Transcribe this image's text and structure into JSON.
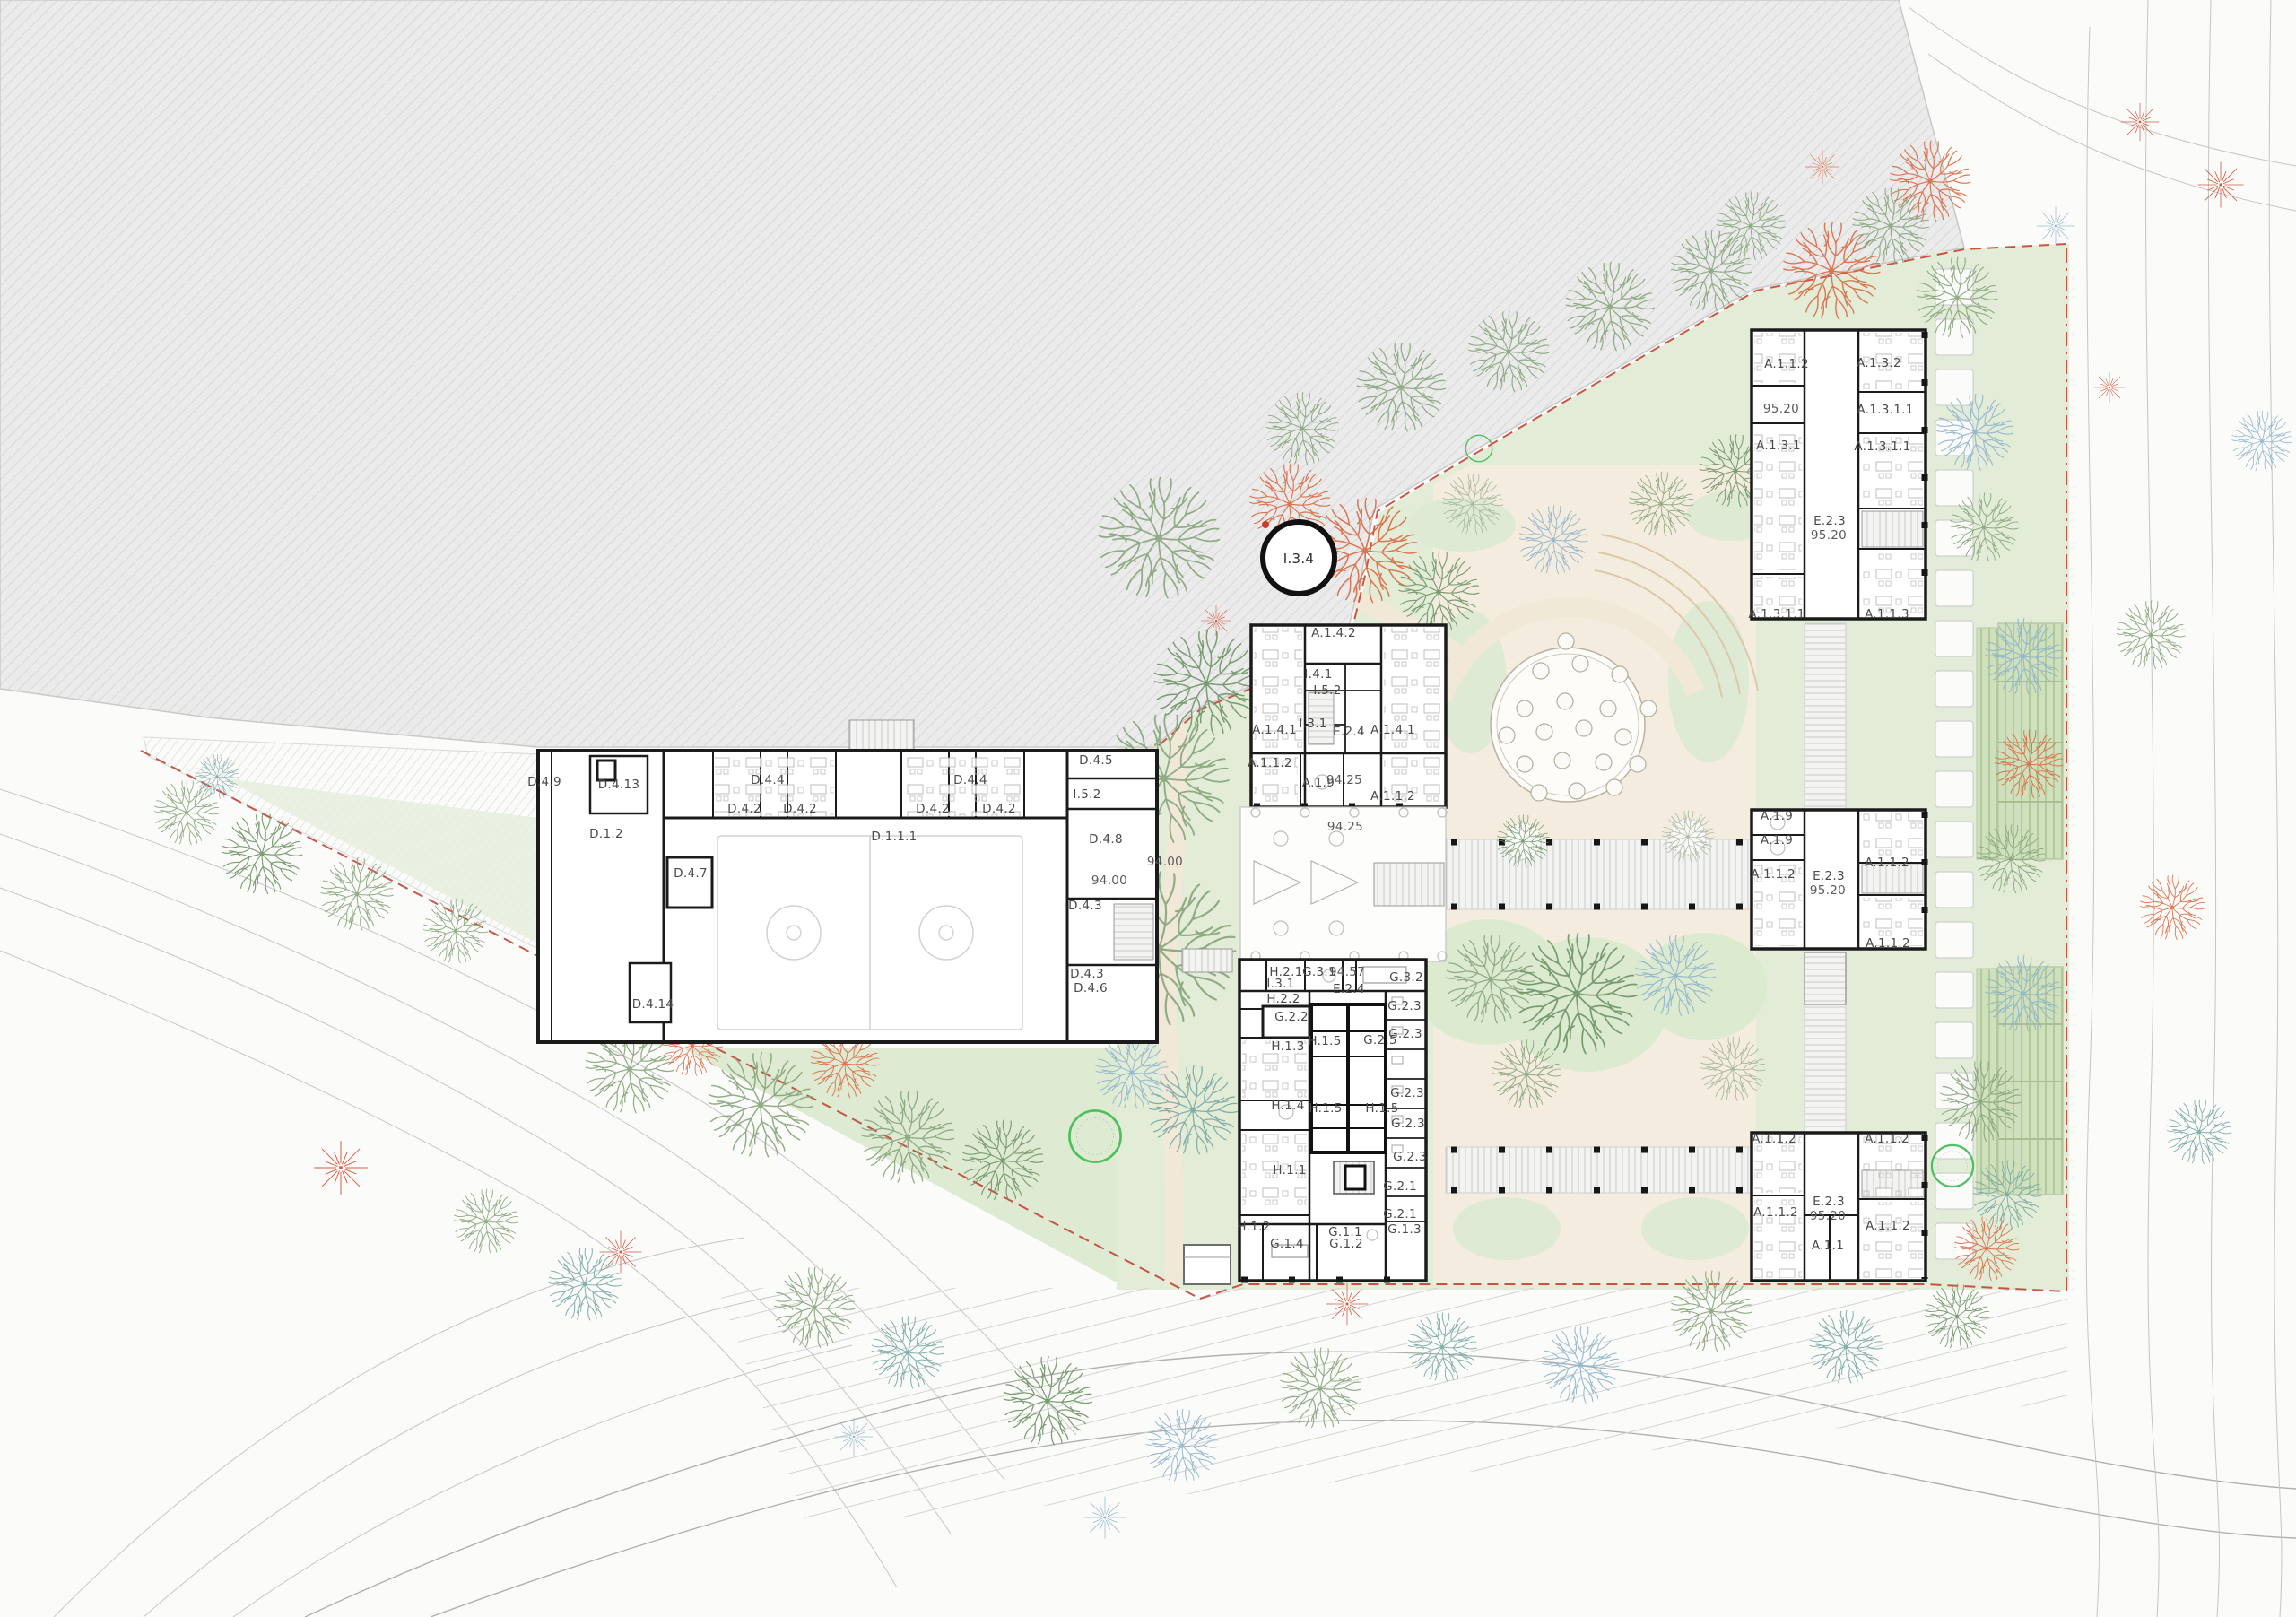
{
  "plan": {
    "levels": {
      "l94_00": "94.00",
      "l94_25": "94.25",
      "l94_57": "94.57",
      "l95_20": "95.20"
    },
    "rooms": {
      "d_1_1_1": "D.1.1.1",
      "d_1_2": "D.1.2",
      "d_4_2": "D.4.2",
      "d_4_3": "D.4.3",
      "d_4_4": "D.4.4",
      "d_4_5": "D.4.5",
      "d_4_6": "D.4.6",
      "d_4_7": "D.4.7",
      "d_4_8": "D.4.8",
      "d_4_9": "D.4.9",
      "d_4_13": "D.4.13",
      "d_4_14": "D.4.14",
      "a_1_1": "A.1.1",
      "a_1_1_2": "A.1.1.2",
      "a_1_1_3": "A.1.1.3",
      "a_1_3_1": "A.1.3.1",
      "a_1_3_1_1": "A.1.3.1.1",
      "a_1_3_2": "A.1.3.2",
      "a_1_4_1": "A.1.4.1",
      "a_1_4_2": "A.1.4.2",
      "a_1_9": "A.1.9",
      "e_2_3": "E.2.3",
      "e_2_4": "E.2.4",
      "g_1_1": "G.1.1",
      "g_1_2": "G.1.2",
      "g_1_3": "G.1.3",
      "g_1_4": "G.1.4",
      "g_2_1": "G.2.1",
      "g_2_2": "G.2.2",
      "g_2_3": "G.2.3",
      "g_2_5": "G.2.5",
      "g_3_1": "G.3.1",
      "g_3_2": "G.3.2",
      "h_1_1": "H.1.1",
      "h_1_2": "H.1.2",
      "h_1_3": "H.1.3",
      "h_1_4": "H.1.4",
      "h_1_5": "H.1.5",
      "h_2_1": "H.2.1",
      "h_2_2": "H.2.2",
      "i_3_1": "I.3.1",
      "i_3_4": "I.3.4",
      "i_4_1": "I.4.1",
      "i_5_2": "I.5.2"
    },
    "colors": {
      "boundary_red": "#c0392b",
      "lawn_green": "#e2ecd7",
      "court_green": "#cfe0bc",
      "path_beige": "#f4ecdf",
      "hatch_gray": "#ebebeb",
      "wall_black": "#1b1b1b",
      "tree_sage": "#87a57b",
      "tree_teal": "#78a8a3",
      "tree_blue": "#8fb4cd",
      "tree_orange": "#d96a42",
      "highlight_green": "#3dbb52"
    }
  }
}
